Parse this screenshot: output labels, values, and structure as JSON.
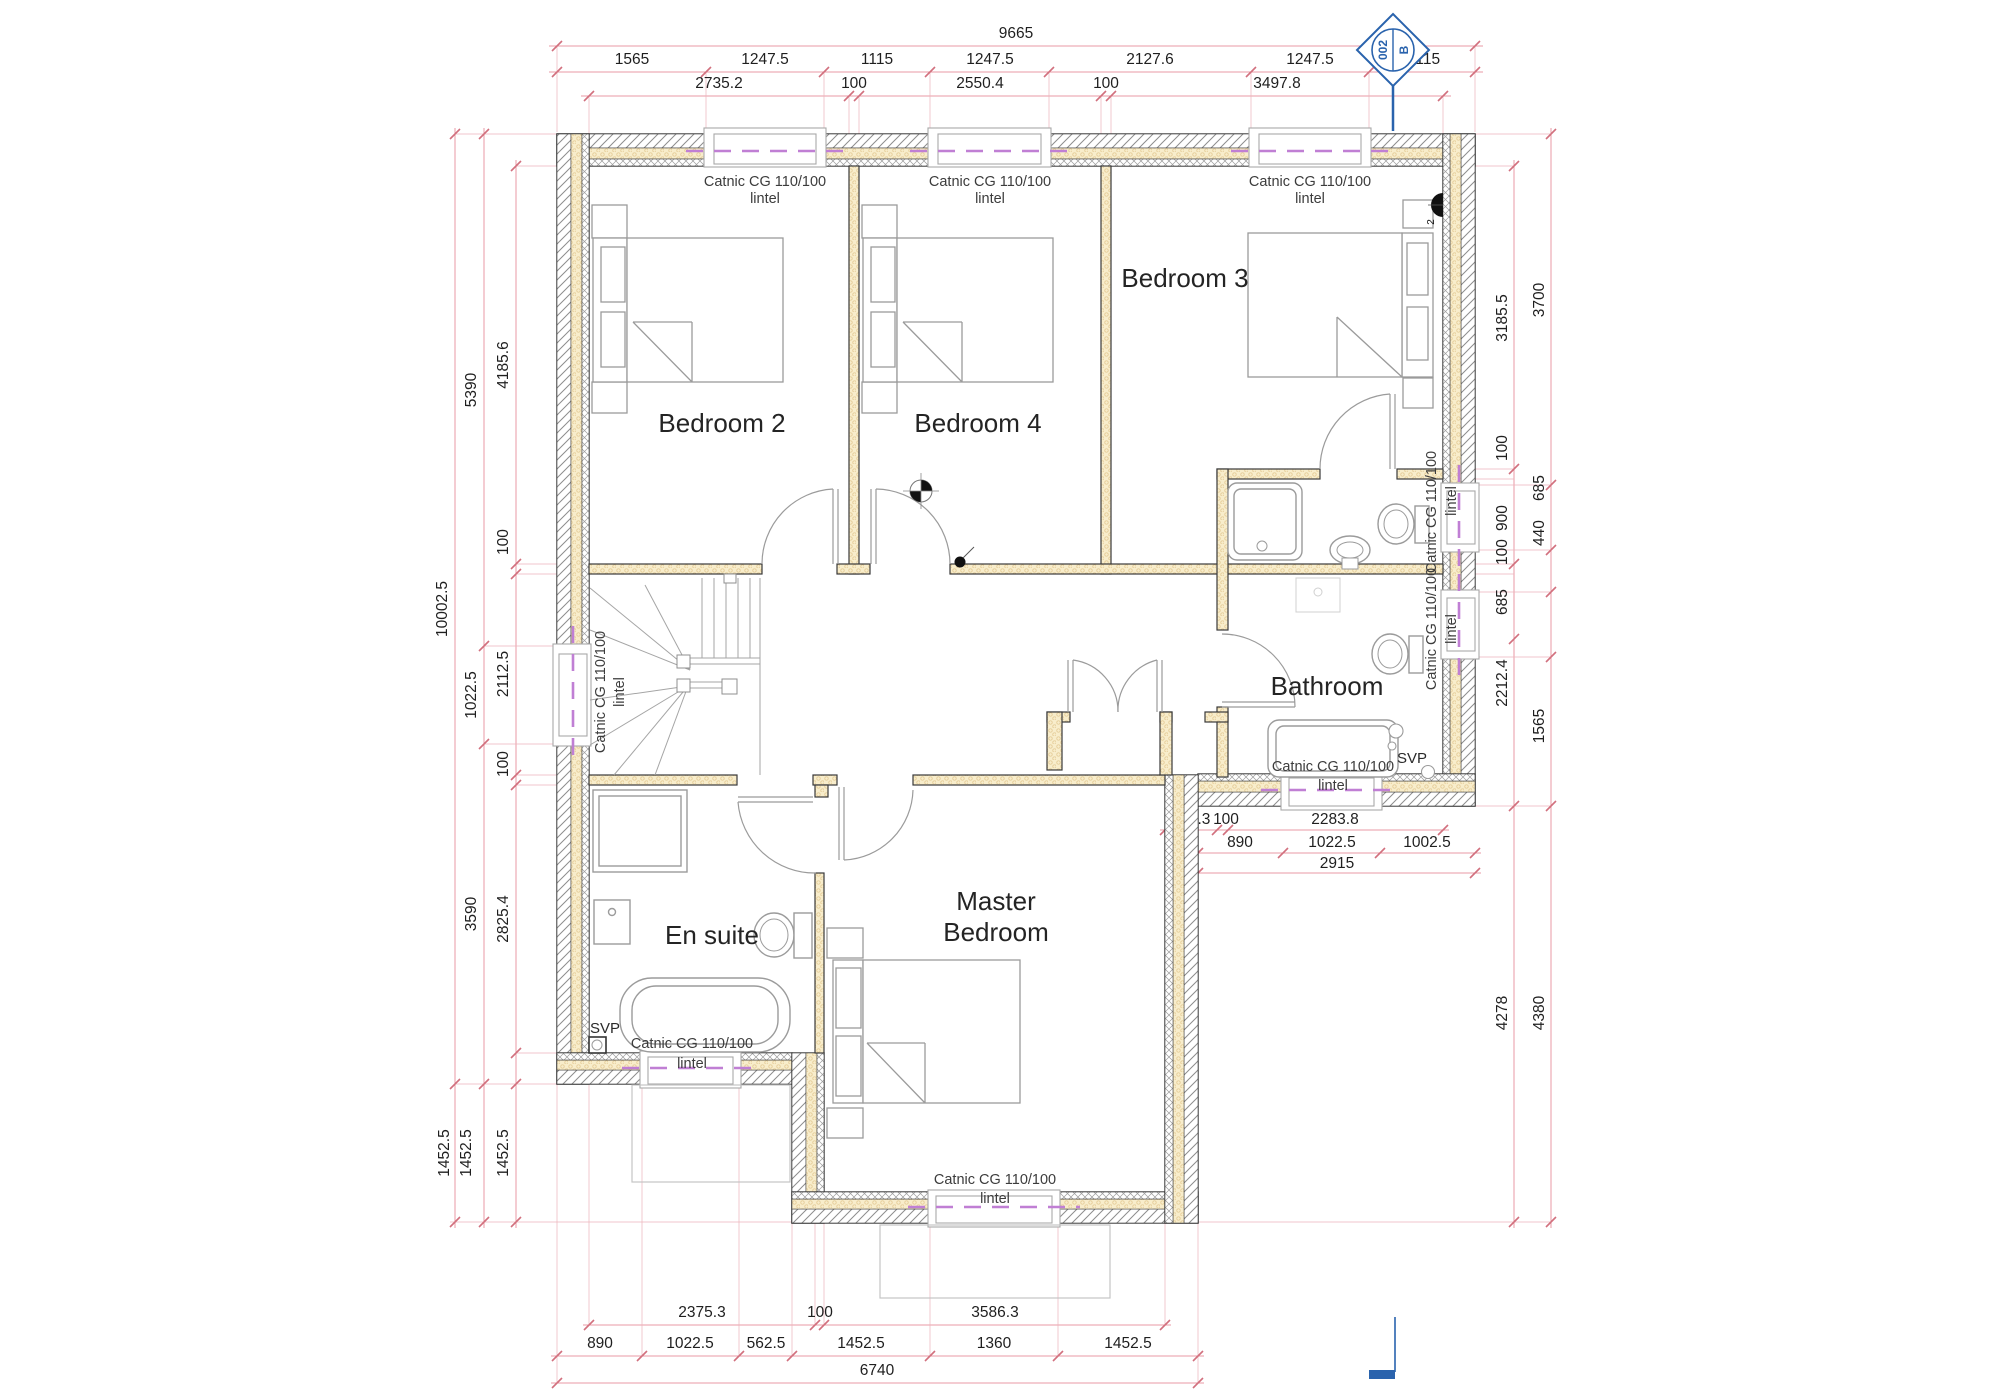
{
  "colors": {
    "dimension_line": "#e0808d",
    "dimension_tick": "#d2707e",
    "lintel_dash": "#c07fd4",
    "cavity_yellow": "#f8edcb",
    "marker_blue": "#2a63ad",
    "furniture_grey": "#9b9b9b"
  },
  "marker": {
    "number": "002",
    "letter": "B"
  },
  "rooms": {
    "bedroom2": "Bedroom 2",
    "bedroom4": "Bedroom 4",
    "bedroom3": "Bedroom 3",
    "bathroom": "Bathroom",
    "ensuite": "En suite",
    "master_line1": "Master",
    "master_line2": "Bedroom"
  },
  "labels": {
    "lintel_line1": "Catnic CG 110/100",
    "lintel_line2": "lintel",
    "svp": "SVP",
    "radiator_tag": "2"
  },
  "dims": {
    "top_overall": "9665",
    "top_row2": [
      "1565",
      "1247.5",
      "1115",
      "1247.5",
      "2127.6",
      "1247.5",
      "1115"
    ],
    "top_row3": [
      "2735.2",
      "100",
      "2550.4",
      "100",
      "3497.8"
    ],
    "left_outer": [
      "10002.5",
      "1452.5"
    ],
    "left_mid": [
      "5390",
      "1022.5",
      "3590",
      "1452.5"
    ],
    "left_inner": [
      "4185.6",
      "100",
      "2112.5",
      "100",
      "2825.4",
      "1452.5"
    ],
    "right_inner": [
      "3185.5",
      "100",
      "900",
      "100",
      "685",
      "2212.4",
      "4278"
    ],
    "right_outer": [
      "3700",
      "685",
      "440",
      "1565",
      "4380"
    ],
    "bath_row1": [
      "543.3",
      "100",
      "2283.8"
    ],
    "bath_row2": [
      "890",
      "1022.5",
      "1002.5"
    ],
    "bath_row3": "2915",
    "bottom_row1": [
      "2375.3",
      "100",
      "3586.3"
    ],
    "bottom_row2": [
      "890",
      "1022.5",
      "562.5",
      "1452.5",
      "1360",
      "1452.5"
    ],
    "bottom_row3": "6740"
  }
}
